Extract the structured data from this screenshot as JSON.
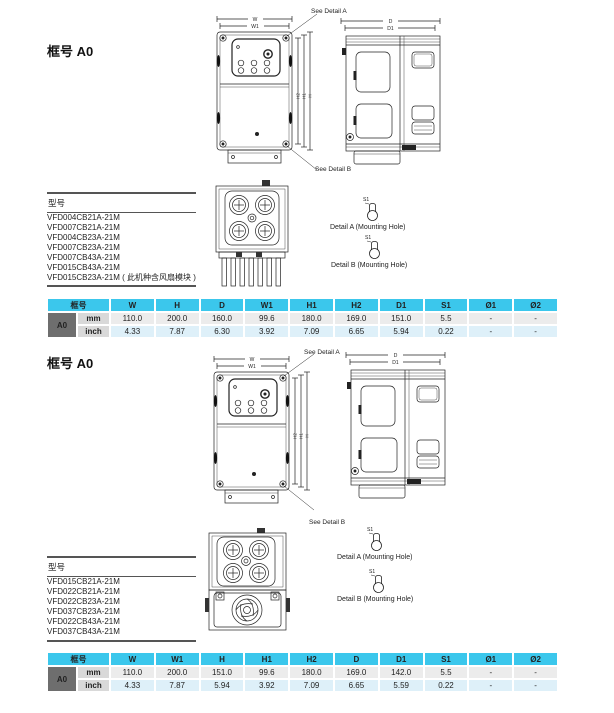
{
  "page": {
    "bg": "#ffffff"
  },
  "labels": {
    "w": "W",
    "w1": "W1",
    "h": "H",
    "h1": "H1",
    "h2": "H2",
    "d": "D",
    "d1": "D1",
    "s1": "S1",
    "see_detail_a": "See Detail A",
    "see_detail_b": "See Detail B",
    "detail_a": "Detail A (Mounting Hole)",
    "detail_b": "Detail B (Mounting Hole)",
    "models_title": "型号"
  },
  "colors": {
    "table_header": "#3bc7ec",
    "frame_cell": "#6e6e6e",
    "unit_cell": "#d9d9d9",
    "mm_row": "#ececec",
    "inch_row": "#def0f9"
  },
  "sections": [
    {
      "heading": "框号 A0",
      "models": [
        "VFD004CB21A-21M",
        "VFD007CB21A-21M",
        "VFD004CB23A-21M",
        "VFD007CB23A-21M",
        "VFD007CB43A-21M",
        "VFD015CB43A-21M",
        "VFD015CB23A-21M ( 此机种含风扇模块 )"
      ],
      "table": {
        "frame_header": "框号",
        "frame": "A0",
        "columns": [
          "W",
          "H",
          "D",
          "W1",
          "H1",
          "H2",
          "D1",
          "S1",
          "Ø1",
          "Ø2"
        ],
        "rows": [
          {
            "unit": "mm",
            "values": [
              "110.0",
              "200.0",
              "160.0",
              "99.6",
              "180.0",
              "169.0",
              "151.0",
              "5.5",
              "-",
              "-"
            ]
          },
          {
            "unit": "inch",
            "values": [
              "4.33",
              "7.87",
              "6.30",
              "3.92",
              "7.09",
              "6.65",
              "5.94",
              "0.22",
              "-",
              "-"
            ]
          }
        ]
      }
    },
    {
      "heading": "框号 A0",
      "models": [
        "VFD015CB21A-21M",
        "VFD022CB21A-21M",
        "VFD022CB23A-21M",
        "VFD037CB23A-21M",
        "VFD022CB43A-21M",
        "VFD037CB43A-21M"
      ],
      "table": {
        "frame_header": "框号",
        "frame": "A0",
        "columns": [
          "W",
          "W1",
          "H",
          "H1",
          "H2",
          "D",
          "D1",
          "S1",
          "Ø1",
          "Ø2"
        ],
        "rows": [
          {
            "unit": "mm",
            "values": [
              "110.0",
              "200.0",
              "151.0",
              "99.6",
              "180.0",
              "169.0",
              "142.0",
              "5.5",
              "-",
              "-"
            ]
          },
          {
            "unit": "inch",
            "values": [
              "4.33",
              "7.87",
              "5.94",
              "3.92",
              "7.09",
              "6.65",
              "5.59",
              "0.22",
              "-",
              "-"
            ]
          }
        ]
      }
    }
  ]
}
